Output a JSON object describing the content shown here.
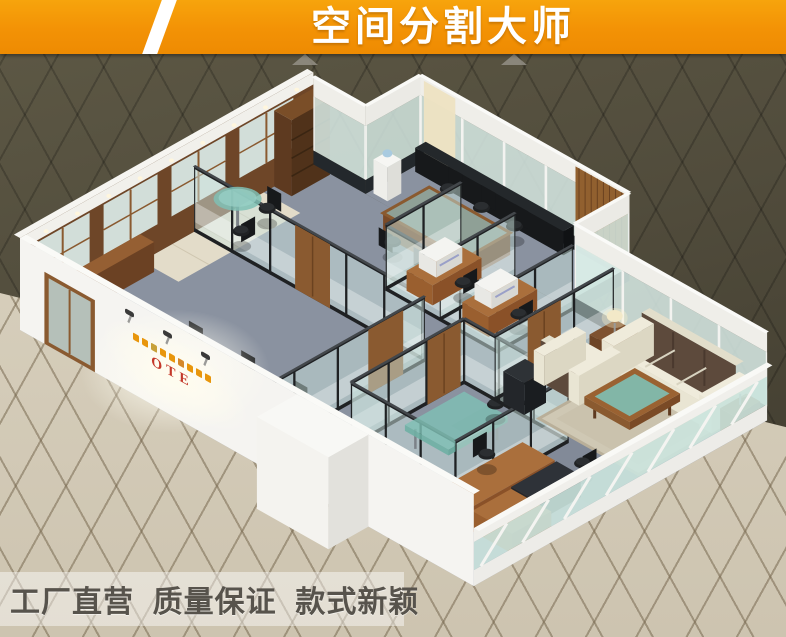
{
  "banner": {
    "title": "空间分割大师",
    "bg_color": "#F39205",
    "text_color": "#FFFFFF"
  },
  "building": {
    "logo_text": "OTE",
    "logo_color": "#C4382A",
    "logo_char_color": "#E8960C"
  },
  "footer": {
    "tagline": "工厂直营  质量保证  款式新颖",
    "text_color": "#57534C"
  },
  "colors": {
    "backdrop_dark": "#514C3C",
    "floor_tile_beige": "#D5CCBA",
    "wall_white": "#F5F4F1",
    "glass_teal": "#CFE4DF",
    "frame_black": "#1F2123",
    "wood_brown": "#8A5A30",
    "wood_dark": "#5E3A20",
    "carpet_gray": "#8A92A0",
    "sofa_cream": "#E9E5D3",
    "cushion_brown": "#5D4A3C",
    "table_glass_teal": "#7FC0B4",
    "marble_band": "#23282C"
  }
}
